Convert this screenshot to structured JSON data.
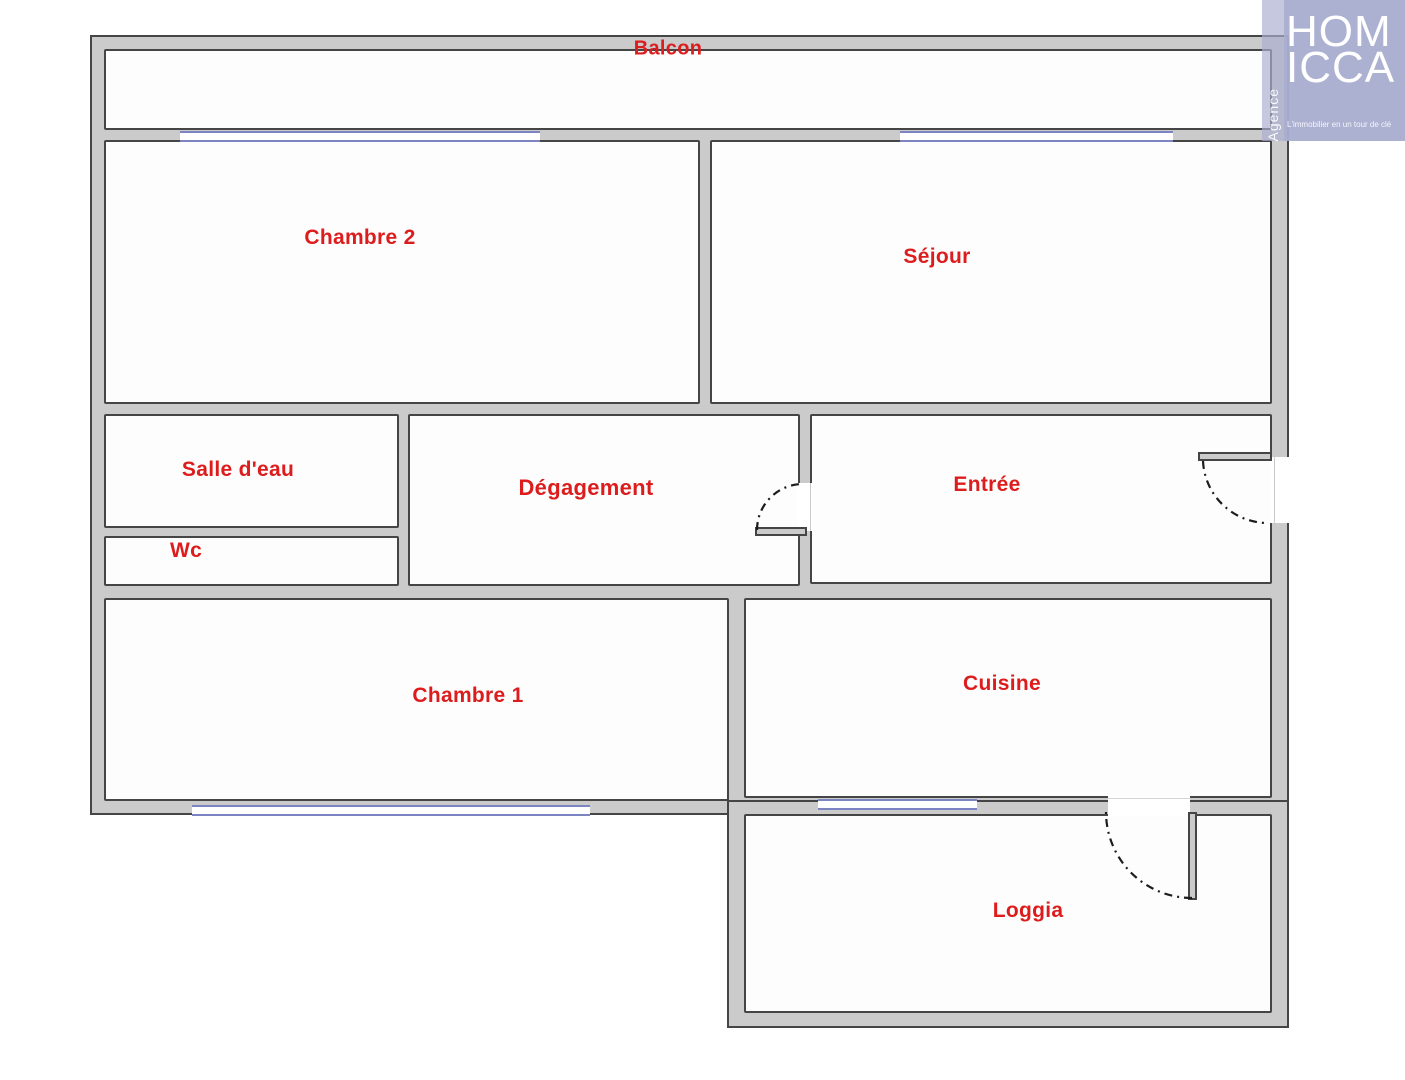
{
  "plan": {
    "rooms": [
      {
        "name": "balcon",
        "label": "Balcon"
      },
      {
        "name": "chambre2",
        "label": "Chambre 2"
      },
      {
        "name": "sejour",
        "label": "Séjour"
      },
      {
        "name": "salle_eau",
        "label": "Salle d'eau"
      },
      {
        "name": "degagement",
        "label": "Dégagement"
      },
      {
        "name": "entree",
        "label": "Entrée"
      },
      {
        "name": "wc",
        "label": "Wc"
      },
      {
        "name": "chambre1",
        "label": "Chambre 1"
      },
      {
        "name": "cuisine",
        "label": "Cuisine"
      },
      {
        "name": "loggia",
        "label": "Loggia"
      }
    ],
    "colors": {
      "label_red": "#dd1d1d",
      "wall_fill": "#cbcbcb",
      "wall_edge": "#454545",
      "window_blue": "#7c84c2",
      "logo_lavender": "#a9aed0"
    }
  },
  "logo": {
    "brand_line1": "HOM",
    "brand_line2": "ICCA",
    "side_label": "Agence",
    "tagline": "L'immobilier en un tour de clé"
  }
}
